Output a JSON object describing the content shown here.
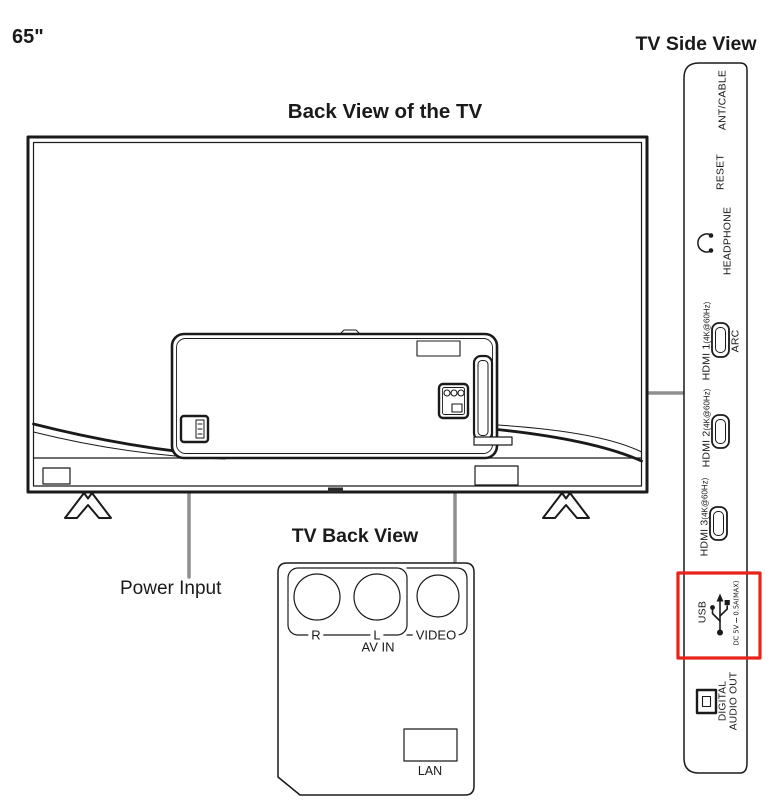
{
  "titles": {
    "size": "65\"",
    "side_view": "TV Side View",
    "back_view": "Back View of the TV",
    "inset_view": "TV Back View",
    "power_input": "Power Input"
  },
  "side_panel": {
    "ant_cable": "ANT/CABLE",
    "reset": "RESET",
    "headphone": "HEADPHONE",
    "hdmi1": "HDMI 1",
    "hdmi1_sub": "(4K@60Hz)",
    "hdmi1_arc": "ARC",
    "hdmi2": "HDMI 2",
    "hdmi2_sub": "(4K@60Hz)",
    "hdmi3": "HDMI 3",
    "hdmi3_sub": "(4K@60Hz)",
    "usb": "USB",
    "usb_spec": "DC 5V ⎓ 0.5A(MAX)",
    "digital_audio_line1": "DIGITAL",
    "digital_audio_line2": "AUDIO OUT"
  },
  "inset": {
    "r": "R",
    "l": "L",
    "video": "VIDEO",
    "av_in": "AV IN",
    "lan": "LAN"
  },
  "icons": {
    "headphone": "headphone-icon",
    "usb": "usb-trident-icon",
    "hdmi": "hdmi-port-icon",
    "optical": "optical-audio-port-icon"
  },
  "colors": {
    "ink": "#1a1a1a",
    "callout_gray": "#8f8f8f",
    "highlight_red": "#e8231a"
  }
}
